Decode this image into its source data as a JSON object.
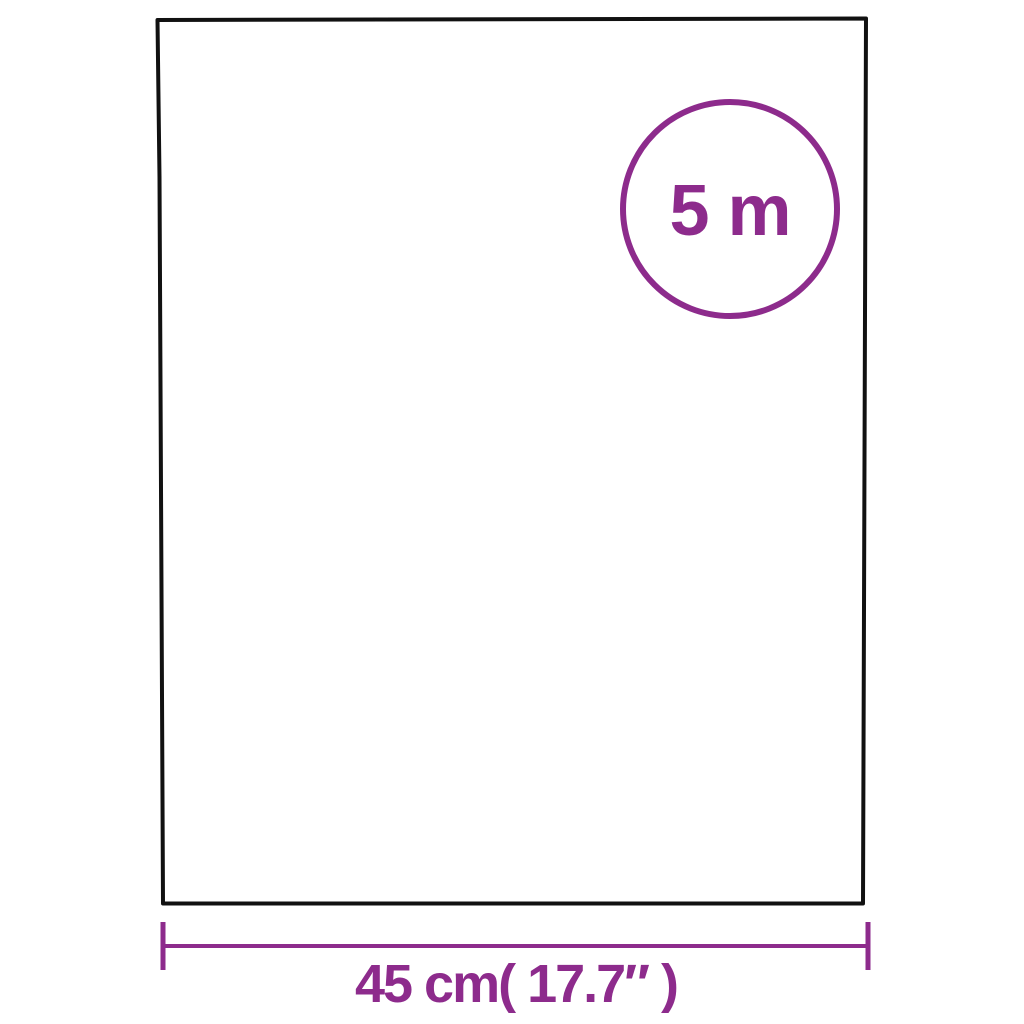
{
  "diagram": {
    "type": "product-dimension-diagram",
    "length_badge": {
      "label": "5 m"
    },
    "width_dimension": {
      "label": "45 cm( 17.7″ )"
    }
  },
  "colors": {
    "accent": "#8D2B8C",
    "outline": "#111111",
    "background": "#FFFFFF"
  }
}
